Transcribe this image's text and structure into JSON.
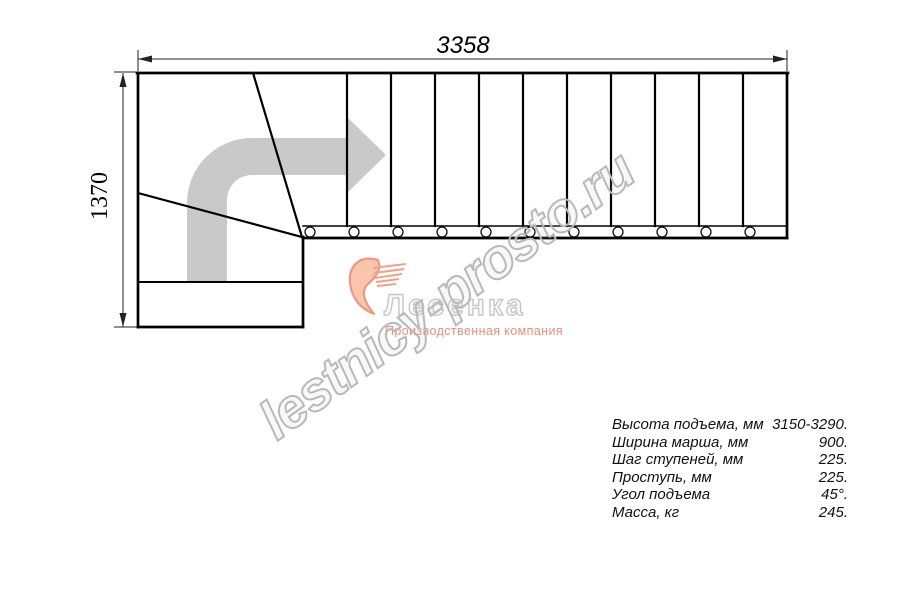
{
  "drawing": {
    "width_label": "3358",
    "height_label": "1370"
  },
  "watermark": {
    "text": "lestnicy-prosto.ru"
  },
  "logo": {
    "name": "Лесенка",
    "tagline": "Производственная компания"
  },
  "specs": {
    "rows": [
      {
        "label": "Высота подъема, мм",
        "value": "3150-3290."
      },
      {
        "label": "Ширина марша, мм",
        "value": "900."
      },
      {
        "label": "Шаг ступеней, мм",
        "value": "225."
      },
      {
        "label": "Проступь, мм",
        "value": "225."
      },
      {
        "label": "Угол подъема",
        "value": "45°."
      },
      {
        "label": "Масса, кг",
        "value": "245."
      }
    ]
  },
  "colors": {
    "line_black": "#000000",
    "dimension": "#222222",
    "arrow_gray": "#c9c9c9",
    "watermark_gray": "#b9b9b9",
    "logo_outline_gray": "#c7c7c7",
    "logo_salmon": "#ee8d7c",
    "logo_swoosh_fill": "#fbc4ad",
    "logo_swoosh_stroke": "#f0937d"
  }
}
